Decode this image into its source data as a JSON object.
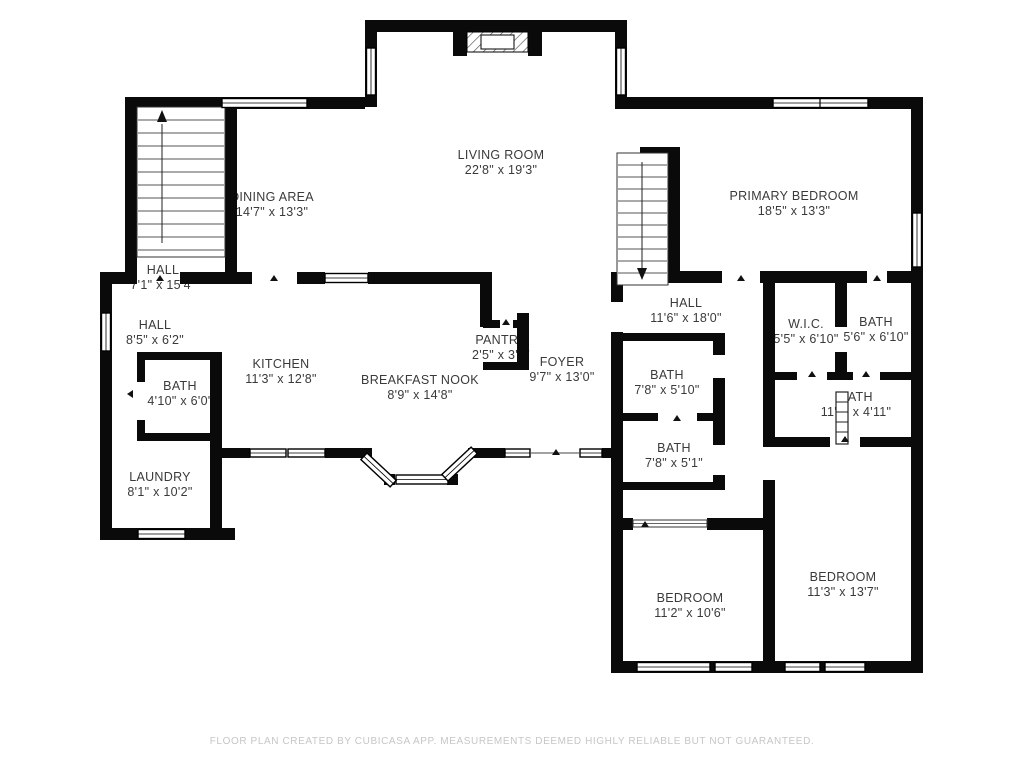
{
  "title": "Floor plan",
  "rooms": [
    {
      "name": "DINING AREA",
      "dims": "14'7\" x 13'3\""
    },
    {
      "name": "LIVING ROOM",
      "dims": "22'8\" x 19'3\""
    },
    {
      "name": "PRIMARY BEDROOM",
      "dims": "18'5\" x 13'3\""
    },
    {
      "name": "HALL",
      "dims": "7'1\" x 15'4\""
    },
    {
      "name": "HALL",
      "dims": "8'5\" x 6'2\""
    },
    {
      "name": "BATH",
      "dims": "4'10\" x 6'0\""
    },
    {
      "name": "LAUNDRY",
      "dims": "8'1\" x 10'2\""
    },
    {
      "name": "KITCHEN",
      "dims": "11'3\" x 12'8\""
    },
    {
      "name": "BREAKFAST NOOK",
      "dims": "8'9\" x 14'8\""
    },
    {
      "name": "PANTRY",
      "dims": "2'5\" x 3'1\""
    },
    {
      "name": "FOYER",
      "dims": "9'7\" x 13'0\""
    },
    {
      "name": "HALL",
      "dims": "11'6\" x 18'0\""
    },
    {
      "name": "W.I.C.",
      "dims": "5'5\" x 6'10\""
    },
    {
      "name": "BATH",
      "dims": "5'6\" x 6'10\""
    },
    {
      "name": "BATH",
      "dims": "7'8\" x 5'10\""
    },
    {
      "name": "BATH",
      "dims": "7'8\" x 5'1\""
    },
    {
      "name": "BATH",
      "dims": "11'3\" x 4'11\""
    },
    {
      "name": "BEDROOM",
      "dims": "11'2\" x 10'6\""
    },
    {
      "name": "BEDROOM",
      "dims": "11'3\" x 13'7\""
    }
  ],
  "footer": {
    "disclaimer": "FLOOR PLAN CREATED BY CUBICASA APP. MEASUREMENTS DEEMED HIGHLY RELIABLE BUT NOT GUARANTEED."
  },
  "colors": {
    "wall": "#0a0a0a",
    "label_text": "#3a3a3a",
    "footer_text": "#c6c6c6"
  }
}
